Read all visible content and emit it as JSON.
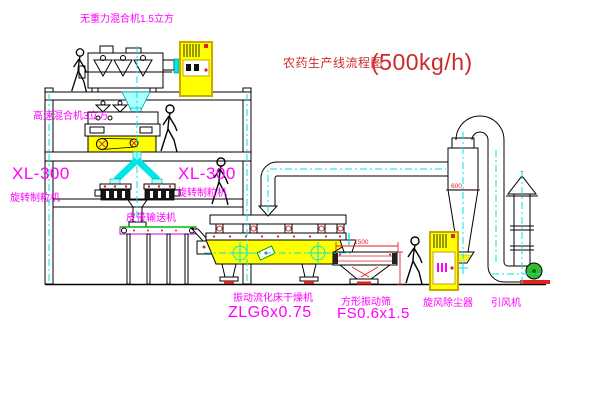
{
  "title": {
    "text": "农药生产线流程图",
    "capacity": "(500kg/h)"
  },
  "labels": {
    "gravity_mixer": "无重力混合机1.5立方",
    "high_speed_mixer": "高速混合机3立方",
    "granulator_left_model": "XL-300",
    "granulator_left_name": "旋转制粒机",
    "granulator_right_model": "XL-300",
    "granulator_right_name": "旋转制粒机",
    "belt_conveyor": "皮带输送机",
    "dryer_name": "振动流化床干燥机",
    "dryer_model": "ZLG6x0.75",
    "sieve_name": "方形振动筛",
    "sieve_model": "FS0.6x1.5",
    "cyclone": "旋风除尘器",
    "fan": "引风机"
  },
  "dimensions": {
    "sieve_length": "1500",
    "cyclone_width": "600"
  },
  "colors": {
    "label": "#ff00ff",
    "title": "#cc2a2a",
    "machine_fill": "#ffff00",
    "centerline": "#00e5e5",
    "dimension": "#dd2222",
    "conveyor_belt": "#00bb00",
    "fan_motor": "#33bb33"
  }
}
